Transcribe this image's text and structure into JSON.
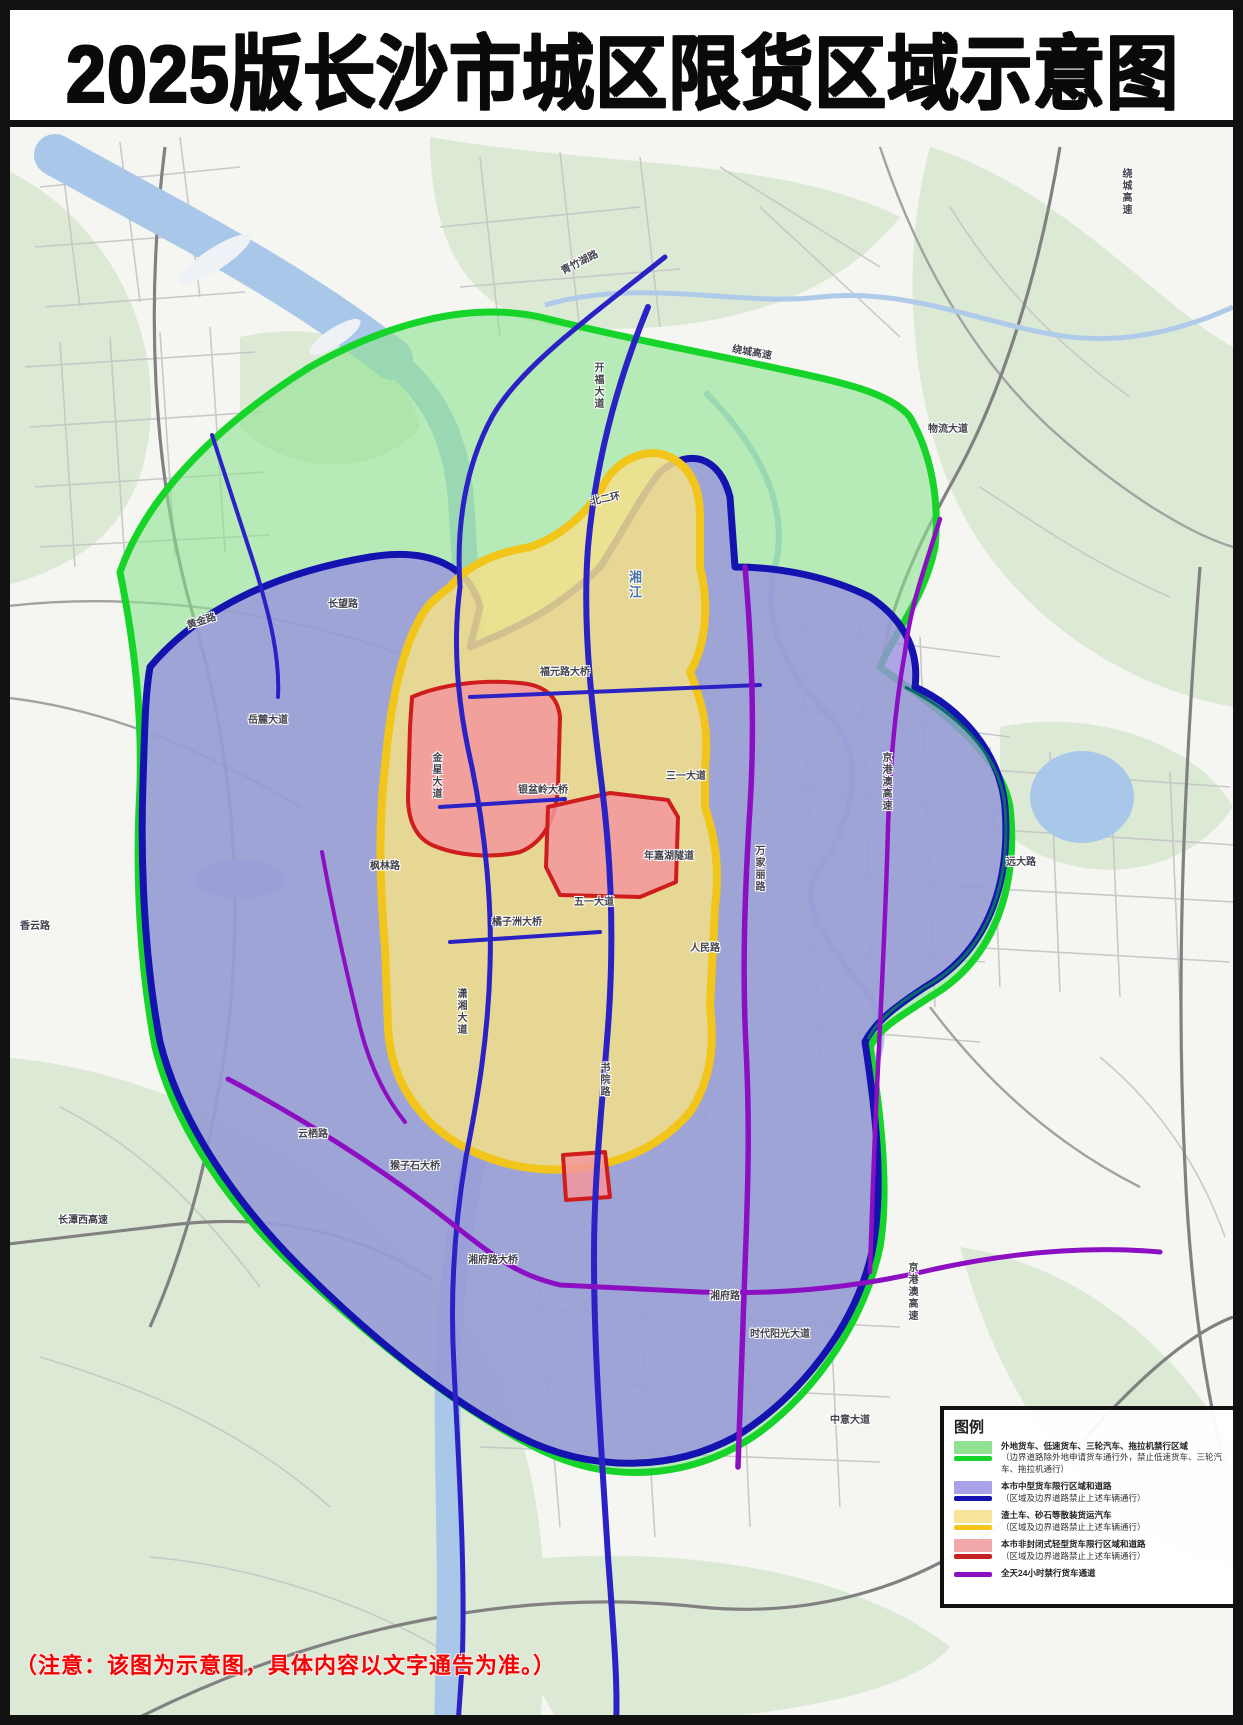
{
  "title": "2025版长沙市城区限货区域示意图",
  "note": "（注意：该图为示意图，具体内容以文字通告为准。）",
  "colors": {
    "green_fill": "#90e292",
    "green_border": "#17d42a",
    "purple_fill": "#9a92e0",
    "purple_border": "#1513b0",
    "yellow_fill": "#f3e08a",
    "yellow_border": "#f2c51a",
    "red_fill": "#f2979e",
    "red_border": "#cf1d1d",
    "route_purple": "#8c10c2",
    "route_blue": "#2a22c4",
    "river": "#a9c7e9",
    "note_red": "#f00505"
  },
  "legend": {
    "title": "图例",
    "rows": [
      {
        "area": "#90e292",
        "line": "#17d42a",
        "line1": "外地货车、低速货车、三轮汽车、拖拉机禁行区域",
        "line2": "（边界道路除外地申请货车通行外，禁止低速货车、三轮汽车、拖拉机通行）"
      },
      {
        "area": "#aaa2e8",
        "line": "#1513b0",
        "line1": "本市中型货车限行区域和道路",
        "line2": "（区域及边界道路禁止上述车辆通行）"
      },
      {
        "area": "#f6e49a",
        "line": "#f2c51a",
        "line1": "渣土车、砂石等散装货运汽车",
        "line2": "（区域及边界道路禁止上述车辆通行）"
      },
      {
        "area": "#f2a7ab",
        "line": "#c32222",
        "line1": "本市非封闭式轻型货车限行区域和道路",
        "line2": "（区域及边界道路禁止上述车辆通行）"
      },
      {
        "area": "",
        "line": "#8c10c2",
        "line1": "全天24小时禁行货车通道",
        "line2": ""
      }
    ]
  },
  "map": {
    "river_name": "湘江",
    "labels": [
      {
        "text": "湘江",
        "x": 628,
        "y": 570,
        "v": true,
        "color": "#4d74a8",
        "size": 13
      },
      {
        "text": "福元路大桥",
        "x": 540,
        "y": 668
      },
      {
        "text": "银盆岭大桥",
        "x": 518,
        "y": 786
      },
      {
        "text": "橘子洲大桥",
        "x": 492,
        "y": 918
      },
      {
        "text": "猴子石大桥",
        "x": 390,
        "y": 1162
      },
      {
        "text": "湘府路大桥",
        "x": 468,
        "y": 1256
      },
      {
        "text": "青竹湖路",
        "x": 560,
        "y": 268,
        "rot": -27
      },
      {
        "text": "物流大道",
        "x": 928,
        "y": 425
      },
      {
        "text": "绕城高速",
        "x": 1120,
        "y": 168,
        "v": true
      },
      {
        "text": "绕城高速",
        "x": 733,
        "y": 345,
        "rot": 10
      },
      {
        "text": "北二环",
        "x": 590,
        "y": 498,
        "rot": -12
      },
      {
        "text": "三一大道",
        "x": 666,
        "y": 772
      },
      {
        "text": "五一大道",
        "x": 574,
        "y": 898
      },
      {
        "text": "人民路",
        "x": 690,
        "y": 944
      },
      {
        "text": "年嘉湖隧道",
        "x": 644,
        "y": 852
      },
      {
        "text": "万家丽路",
        "x": 753,
        "y": 845,
        "v": true
      },
      {
        "text": "京港澳高速",
        "x": 880,
        "y": 752,
        "v": true
      },
      {
        "text": "京港澳高速",
        "x": 906,
        "y": 1262,
        "v": true
      },
      {
        "text": "时代阳光大道",
        "x": 750,
        "y": 1330
      },
      {
        "text": "中意大道",
        "x": 830,
        "y": 1416
      },
      {
        "text": "长潭西高速",
        "x": 58,
        "y": 1216
      },
      {
        "text": "云栖路",
        "x": 298,
        "y": 1130
      },
      {
        "text": "香云路",
        "x": 20,
        "y": 922
      },
      {
        "text": "黄金路",
        "x": 186,
        "y": 622,
        "rot": -18
      },
      {
        "text": "长望路",
        "x": 328,
        "y": 600
      },
      {
        "text": "岳麓大道",
        "x": 248,
        "y": 716
      },
      {
        "text": "金星大道",
        "x": 430,
        "y": 752,
        "v": true
      },
      {
        "text": "枫林路",
        "x": 370,
        "y": 862
      },
      {
        "text": "开福大道",
        "x": 592,
        "y": 362,
        "v": true
      },
      {
        "text": "远大路",
        "x": 1006,
        "y": 858
      },
      {
        "text": "湘府路",
        "x": 710,
        "y": 1292
      },
      {
        "text": "潇湘大道",
        "x": 455,
        "y": 988,
        "v": true
      },
      {
        "text": "书院路",
        "x": 598,
        "y": 1062,
        "v": true
      }
    ]
  }
}
